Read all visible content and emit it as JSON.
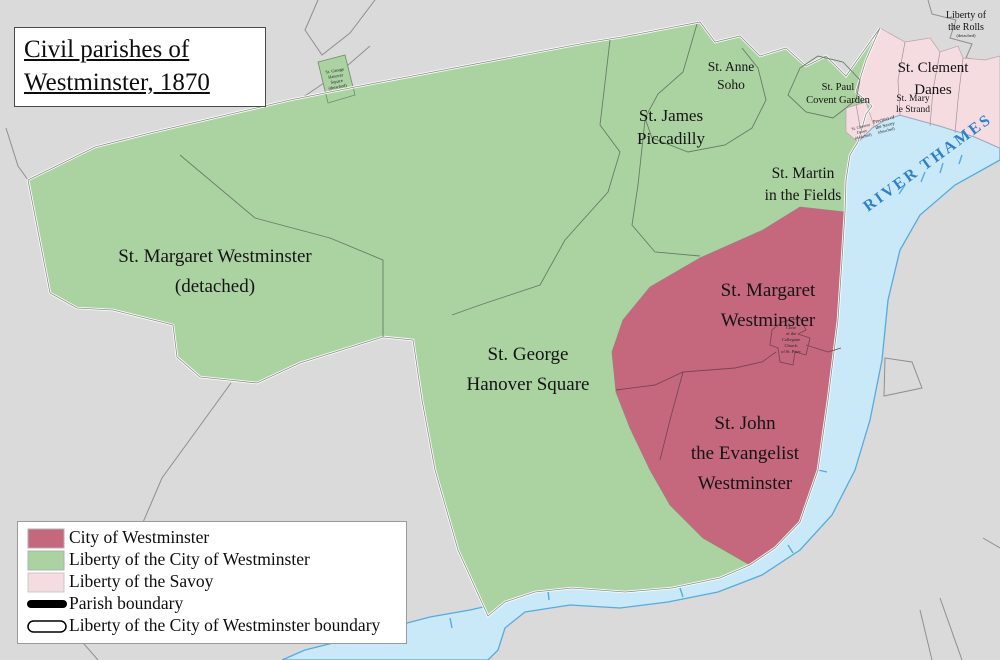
{
  "title": {
    "line1": "Civil parishes of",
    "line2": "Westminster, 1870"
  },
  "colors": {
    "land_gray": "#dadada",
    "boundary_gray": "#8f8f8f",
    "liberty_green": "#abd3a1",
    "city_red": "#c5687e",
    "savoy_pink": "#f5dce1",
    "river_blue": "#c9e9f9",
    "river_edge": "#55abdf",
    "river_label_blue": "#2f80ca",
    "black": "#000000",
    "white": "#ffffff"
  },
  "map": {
    "labels": {
      "st_margaret_detached": [
        "St. Margaret Westminster",
        "(detached)"
      ],
      "st_george": [
        "St. George",
        "Hanover Square"
      ],
      "st_james": [
        "St. James",
        "Piccadilly"
      ],
      "st_anne": [
        "St. Anne",
        "Soho"
      ],
      "st_martin": [
        "St. Martin",
        "in the Fields"
      ],
      "st_paul": [
        "St. Paul",
        "Covent Garden"
      ],
      "st_clement": [
        "St. Clement",
        "Danes"
      ],
      "st_mary": [
        "St. Mary",
        "le Strand"
      ],
      "liberty_rolls": [
        "Liberty of",
        "the Rolls",
        "(detached)"
      ],
      "st_margaret": [
        "St. Margaret",
        "Westminster"
      ],
      "st_john": [
        "St. John",
        "the Evangelist",
        "Westminster"
      ],
      "river": "RIVER THAMES",
      "george_detached_tiny": [
        "St. George",
        "Hanover",
        "Square",
        "(detached)"
      ],
      "savoy_tiny": [
        "Precinct of",
        "the Savoy",
        "(detached)"
      ],
      "clement_detached_tiny": [
        "St. Clement",
        "Danes",
        "(detached)"
      ],
      "abbey_close_tiny": [
        "Close",
        "of the",
        "Collegiate",
        "Church",
        "of St. Peter"
      ]
    }
  },
  "legend": {
    "items": [
      {
        "label": "City of Westminster",
        "swatch_color": "#c5687e"
      },
      {
        "label": "Liberty of the City of Westminster",
        "swatch_color": "#abd3a1"
      },
      {
        "label": "Liberty of the Savoy",
        "swatch_color": "#f5dce1"
      },
      {
        "label": "Parish boundary"
      },
      {
        "label": "Liberty of the City of Westminster boundary"
      }
    ]
  }
}
